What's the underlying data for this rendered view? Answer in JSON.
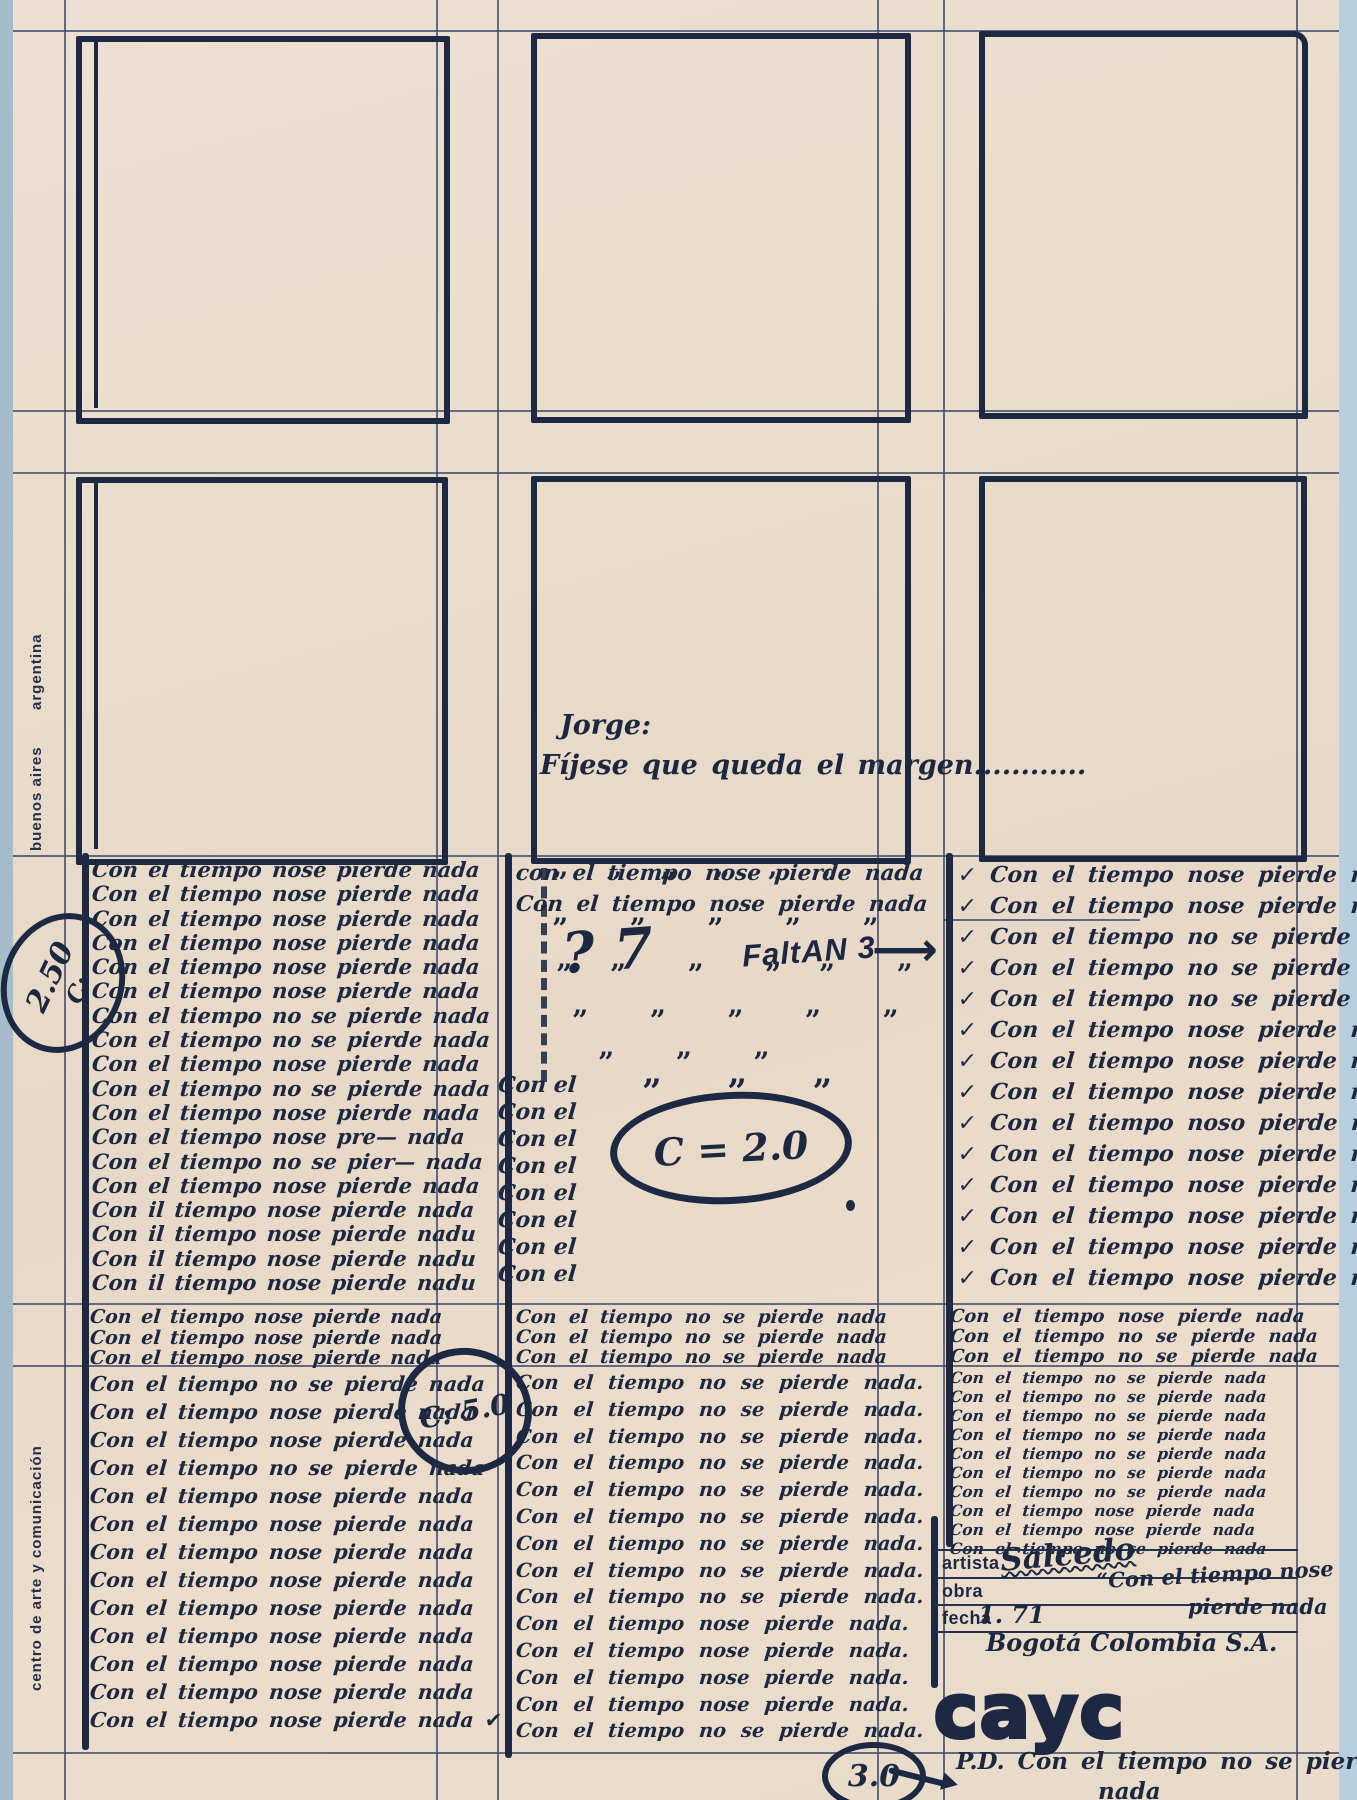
{
  "page": {
    "width": 1357,
    "height": 1800,
    "paper_color": "#e8dccb",
    "ink_color": "#1d2942",
    "rule_color": "#3c496a",
    "scan_edge_color": "#a6bccb"
  },
  "sidebar": {
    "argentina": "argentina",
    "buenos_aires": "buenos aires",
    "centro": "centro de arte y comunicación"
  },
  "note_jorge": {
    "line1": "Jorge:",
    "line2": "Fíjese que queda el margen............"
  },
  "annotations": {
    "c250": {
      "value": "2.50",
      "label": "C:"
    },
    "c20": {
      "text": "C = 2.0"
    },
    "c50": {
      "text": "C: 5.0"
    },
    "c30": {
      "text": "3.0"
    },
    "faltan": {
      "question": "? 7",
      "text": "FaltAN 3",
      "arrow": "⟶"
    },
    "pd": {
      "line1": "P.D.  Con el tiempo no se pierde",
      "line2": "nada"
    },
    "ditto": {
      "r1": "” ” ” ” ” ”",
      "r2": "”  ”  ”  ”  ”",
      "r3": "” ”  ”  ” ”  ”",
      "r4": "”  ”  ”  ”  ”",
      "r5": "”  ”  ”",
      "r6": "”  ”  ”"
    }
  },
  "form": {
    "artista_label": "artista",
    "obra_label": "obra",
    "fecha_label": "fecha",
    "artista_value": "Salcedo",
    "obra_value": "“Con el tiempo nose",
    "obra_value2": "pierde nada",
    "fecha_value": "1. 71",
    "city": "Bogotá Colombia S.A.",
    "logo": "cayc"
  },
  "columns": {
    "col1": {
      "block1": [
        "Con el tiempo nose pierde nada",
        "Con el tiempo nose pierde nada",
        "Con el tiempo nose pierde nada",
        "Con el tiempo nose pierde nada",
        "Con el tiempo nose pierde nada",
        "Con el tiempo nose pierde nada",
        "Con el tiempo no se pierde nada",
        "Con el tiempo no se pierde nada",
        "Con el tiempo nose pierde nada",
        "Con el tiempo no se pierde nada",
        "Con el tiempo nose pierde nada",
        "Con el tiempo nose pre— nada",
        "Con el tiempo no se pier— nada",
        "Con el tiempo nose pierde nada",
        "Con il tiempo nose pierde nada",
        "Con il tiempo nose pierde nadu",
        "Con il tiempo nose pierde nadu",
        "Con il tiempo nose pierde nadu"
      ],
      "block2": [
        "Con el tiempo nose pierde nada",
        "Con el tiempo nose pierde nada",
        "Con el tiempo nose pierde nada"
      ],
      "block3": [
        "Con el tiempo no se pierde nada",
        "Con el tiempo nose pierde nada",
        "Con el tiempo nose pierde nada",
        "Con el tiempo no se pierde nada",
        "Con el tiempo nose pierde nada",
        "Con el tiempo nose pierde nada",
        "Con el tiempo nose pierde nada",
        "Con el tiempo nose pierde nada",
        "Con el tiempo nose pierde nada",
        "Con el tiempo nose pierde nada",
        "Con el tiempo nose pierde nada",
        "Con el tiempo nose pierde nada",
        "Con el tiempo nose pierde nada ✔"
      ]
    },
    "col2": {
      "top": [
        "con el tiempo nose pierde nada",
        "Con el tiempo nose pierde nada"
      ],
      "con_el_stack": [
        "Con el",
        "Con el",
        "Con el",
        "Con el",
        "Con el",
        "Con el",
        "Con el",
        "Con el"
      ],
      "block2": [
        "Con el tiempo no se pierde nada",
        "Con el tiempo no se pierde nada",
        "Con el tiempo no se pierde nada"
      ],
      "block3": [
        "Con el tiempo no se pierde nada.",
        "Con el tiempo no se pierde nada.",
        "Con el tiempo no se pierde nada.",
        "Con el tiempo no se pierde nada.",
        "Con el tiempo no se pierde nada.",
        "Con el tiempo no se pierde nada.",
        "Con el tiempo no se pierde nada.",
        "Con el tiempo no se pierde nada.",
        "Con el tiempo no se pierde nada.",
        "Con el tiempo nose pierde nada.",
        "Con el tiempo nose pierde nada.",
        "Con el tiempo nose pierde nada.",
        "Con el tiempo nose pierde nada.",
        "Con el tiempo no se pierde nada."
      ]
    },
    "col3": {
      "block1": [
        "✓ Con el tiempo nose pierde nada",
        "✓ Con el tiempo nose pierde nada",
        "✓ Con el tiempo no se pierde nada",
        "✓ Con el tiempo no se pierde nada",
        "✓ Con el tiempo no se pierde nada",
        "✓ Con el tiempo nose pierde nada",
        "✓ Con el tiempo nose pierde nada",
        "✓ Con el tiempo nose pierde nada",
        "✓ Con el tiempo noso pierde nada",
        "✓ Con el tiempo nose pierde nada",
        "✓ Con el tiempo nose pierde nada",
        "✓ Con el tiempo nose pierde nada",
        "✓ Con el tiempo nose pierde nada",
        "✓ Con el tiempo nose pierde nada"
      ],
      "block2": [
        "Con el tiempo nose pierde nada",
        "Con el tiempo no se pierde nada",
        "Con el tiempo no se pierde nada"
      ],
      "block3": [
        "Con el tiempo no se pierde nada",
        "Con el tiempo no se pierde nada",
        "Con el tiempo no se pierde nada",
        "Con el tiempo no se pierde nada",
        "Con el tiempo no se pierde nada",
        "Con el tiempo no se pierde nada",
        "Con el tiempo no se pierde nada",
        "Con el tiempo nose pierde nada",
        "Con el tiempo nose pierde nada",
        "Con el tiempo no se pierde nada"
      ]
    }
  }
}
